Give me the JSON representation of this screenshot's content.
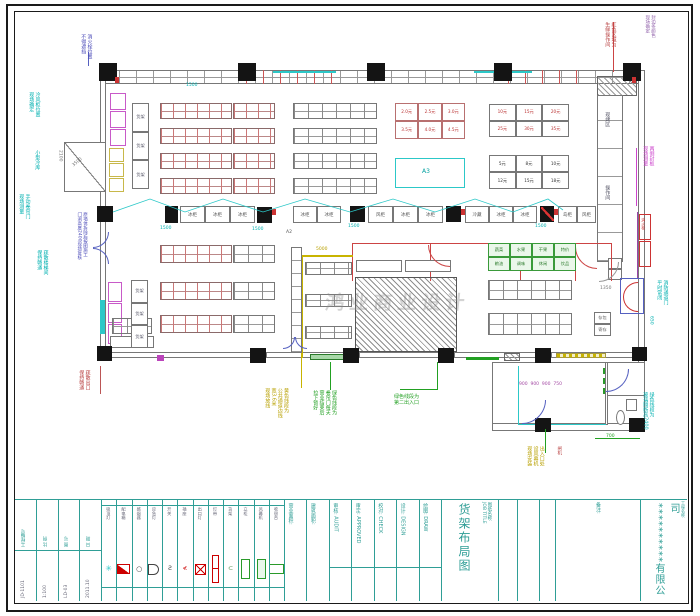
{
  "titleblock": {
    "info_table": {
      "columns": [
        {
          "label": "工程编号",
          "value": "JD-1101"
        },
        {
          "label": "比 例",
          "value": "1:100"
        },
        {
          "label": "图 号",
          "value": "LD-03"
        },
        {
          "label": "日 期",
          "value": "2011.10"
        }
      ]
    },
    "sign_columns": [
      "营业面积:",
      "建筑面积:",
      "审核: AUDIT",
      "审定: APPROVED",
      "校对: CHECK",
      "设计: DESIGN",
      "绘图: DRAW"
    ],
    "title_label": "图纸名称:",
    "title_label_en": "JOB TITLE",
    "title": "货架布局图",
    "notes_label": "备注:",
    "project_label": "工程名称:",
    "company": "**********有限公司"
  },
  "legend": {
    "items": [
      {
        "label": "吸顶灯",
        "sym": "burst"
      },
      {
        "label": "配电箱",
        "sym": "tribox"
      },
      {
        "label": "感烟器",
        "sym": "circle"
      },
      {
        "label": "应急灯",
        "sym": "half"
      },
      {
        "label": "开关",
        "sym": "s"
      },
      {
        "label": "插座",
        "sym": "lt"
      },
      {
        "label": "出口灯",
        "sym": "xbox"
      },
      {
        "label": "灯带",
        "sym": "vbar"
      },
      {
        "label": "货架",
        "sym": "c"
      },
      {
        "label": "立柜",
        "sym": "vrect"
      },
      {
        "label": "风幕机",
        "sym": "vrect2"
      },
      {
        "label": "收银台",
        "sym": "hrect"
      }
    ]
  },
  "plan": {
    "aisle_cells": [
      "冰柜",
      "冰柜",
      "冰柜",
      "冰柜",
      "冰柜",
      "风柜",
      "冰柜",
      "冰柜",
      "冷藏",
      "冰柜",
      "冰柜",
      "岛柜",
      "风柜"
    ],
    "price_grid_a": [
      "2.0元",
      "2.5元",
      "3.0元",
      "3.5元",
      "4.0元",
      "4.5元"
    ],
    "price_grid_b": [
      "10元",
      "15元",
      "20元",
      "25元",
      "30元",
      "35元"
    ],
    "price_grid_c": [
      "5元",
      "8元",
      "10元",
      "12元",
      "15元",
      "18元"
    ],
    "green_grid": [
      "蔬菜",
      "水果",
      "干果",
      "特价",
      "粮油",
      "调味",
      "休闲",
      "饮品"
    ],
    "locker": [
      "存包",
      "寄存"
    ],
    "side_shelf_a": [
      "货架",
      "货架",
      "货架"
    ],
    "side_shelf_b": [
      "货架",
      "货架",
      "货架"
    ],
    "watermark": "鸿业商业设计"
  },
  "annotations": [
    {
      "n": "hydrant-note",
      "x": 80,
      "y": 34,
      "c": "#4a4ab8",
      "lines": [
        "消火栓位置",
        "不得遮挡"
      ]
    },
    {
      "n": "red-zone-note",
      "x": 604,
      "y": 22,
      "c": "#b84040",
      "lines": [
        "红色区域为",
        "生鲜操作间"
      ]
    },
    {
      "n": "corner-note",
      "x": 644,
      "y": 15,
      "c": "#9060aa",
      "fs": 4.5,
      "lines": [
        "封边条颜色",
        "现场确定"
      ]
    },
    {
      "n": "cold-cabinet-note",
      "x": 28,
      "y": 92,
      "c": "#00b0b0",
      "lines": [
        "冷风柜位置",
        "现场确定"
      ]
    },
    {
      "n": "cold-room-note",
      "x": 34,
      "y": 150,
      "c": "#00b0b0",
      "lines": [
        "小型冷库"
      ]
    },
    {
      "n": "shutter-note-left",
      "x": 18,
      "y": 194,
      "c": "#00b0b0",
      "lines": [
        "手动卷帘门",
        "现场测量"
      ]
    },
    {
      "n": "wall-demolish-note",
      "x": 76,
      "y": 212,
      "c": "#4a4ab8",
      "fs": 4.5,
      "lines": [
        "原墙体拆除后按图施工",
        "门洞高度2400现场复核"
      ]
    },
    {
      "n": "stair-note",
      "x": 36,
      "y": 250,
      "c": "#00b0b0",
      "lines": [
        "疏散楼梯间",
        "保持畅通"
      ]
    },
    {
      "n": "exit-note-bl",
      "x": 78,
      "y": 370,
      "c": "#b84040",
      "lines": [
        "疏散出口",
        "保持畅通"
      ]
    },
    {
      "n": "edge-seal-note",
      "x": 642,
      "y": 146,
      "c": "#cc44cc",
      "lines": [
        "两侧封板",
        "现场测量"
      ]
    },
    {
      "n": "fire-door-note",
      "x": 656,
      "y": 280,
      "c": "#00b0b0",
      "lines": [
        "消防通道门",
        "平时常闭"
      ]
    },
    {
      "n": "glass-note",
      "x": 642,
      "y": 392,
      "c": "#00b0b0",
      "lines": [
        "绿色线段为",
        "玻璃隔断高2400"
      ]
    },
    {
      "n": "yellow-line-note",
      "x": 264,
      "y": 388,
      "c": "#b8a000",
      "lines": [
        "黄色线段为",
        "公共通道边线",
        "宽3.6米",
        "现场放线"
      ]
    },
    {
      "n": "shutter-note-center",
      "x": 312,
      "y": 390,
      "c": "#22a022",
      "lines": [
        "绿色线段为",
        "卷帘门每天",
        "营业结束后",
        "拉下锁好"
      ]
    },
    {
      "n": "second-exit-note",
      "x": 394,
      "y": 394,
      "c": "#22a022",
      "dir": "h",
      "fs": 5,
      "lines": [
        "绿色线段为",
        "第二出入口"
      ]
    },
    {
      "n": "air-curtain-note",
      "x": 526,
      "y": 446,
      "c": "#b8a000",
      "lines": [
        "出入口处",
        "设风幕机",
        "现场安装"
      ]
    },
    {
      "n": "gate-note",
      "x": 556,
      "y": 446,
      "c": "#b84040",
      "fs": 4.5,
      "lines": [
        "闸机"
      ]
    },
    {
      "n": "counter-label-1",
      "x": 604,
      "y": 112,
      "c": "#556",
      "lines": [
        "现烤区"
      ]
    },
    {
      "n": "counter-label-2",
      "x": 604,
      "y": 185,
      "c": "#556",
      "lines": [
        "操作间"
      ]
    },
    {
      "n": "hydrant-box-label",
      "x": 641,
      "y": 218,
      "c": "#cc3333",
      "fs": 4,
      "lines": [
        "消火栓"
      ]
    },
    {
      "n": "zone-a3",
      "x": 422,
      "y": 168,
      "c": "#00a0a0",
      "dir": "h",
      "fs": 6,
      "lines": [
        "A3"
      ]
    },
    {
      "n": "zone-a2",
      "x": 286,
      "y": 230,
      "c": "#555",
      "dir": "h",
      "fs": 4.5,
      "lines": [
        "A2"
      ]
    },
    {
      "n": "dim-aisle-1",
      "x": 160,
      "y": 226,
      "c": "#00b0b0",
      "dir": "h",
      "fs": 4.5,
      "lines": [
        "1500"
      ]
    },
    {
      "n": "dim-aisle-2",
      "x": 252,
      "y": 227,
      "c": "#00b0b0",
      "dir": "h",
      "fs": 4.5,
      "lines": [
        "1500"
      ]
    },
    {
      "n": "dim-aisle-3",
      "x": 348,
      "y": 224,
      "c": "#00b0b0",
      "dir": "h",
      "fs": 4.5,
      "lines": [
        "1500"
      ]
    },
    {
      "n": "dim-aisle-4",
      "x": 535,
      "y": 224,
      "c": "#00b0b0",
      "dir": "h",
      "fs": 4.5,
      "lines": [
        "1500"
      ]
    },
    {
      "n": "dim-top",
      "x": 186,
      "y": 83,
      "c": "#00b0b0",
      "dir": "h",
      "fs": 4.5,
      "lines": [
        "1500"
      ]
    },
    {
      "n": "dim-650",
      "x": 648,
      "y": 316,
      "c": "#00b0b0",
      "fs": 4.5,
      "lines": [
        "650"
      ]
    },
    {
      "n": "dim-1350",
      "x": 600,
      "y": 286,
      "c": "#777",
      "dir": "h",
      "fs": 4.5,
      "lines": [
        "1350"
      ]
    },
    {
      "n": "dim-700",
      "x": 606,
      "y": 434,
      "c": "#22a022",
      "dir": "h",
      "fs": 4.5,
      "lines": [
        "700"
      ]
    },
    {
      "n": "dim-5000",
      "x": 316,
      "y": 247,
      "c": "#b8a000",
      "dir": "h",
      "fs": 4.5,
      "lines": [
        "5000"
      ]
    },
    {
      "n": "dim-3500",
      "x": 72,
      "y": 160,
      "c": "#777",
      "dir": "h",
      "fs": 4.5,
      "rot": -40,
      "lines": [
        "3500"
      ]
    },
    {
      "n": "dim-2100",
      "x": 57,
      "y": 150,
      "c": "#777",
      "fs": 4.5,
      "lines": [
        "2100"
      ]
    },
    {
      "n": "checkout-dims",
      "x": 519,
      "y": 382,
      "c": "#a44aa4",
      "dir": "h",
      "fs": 4.5,
      "lines": [
        "900  900  900  750"
      ]
    }
  ]
}
